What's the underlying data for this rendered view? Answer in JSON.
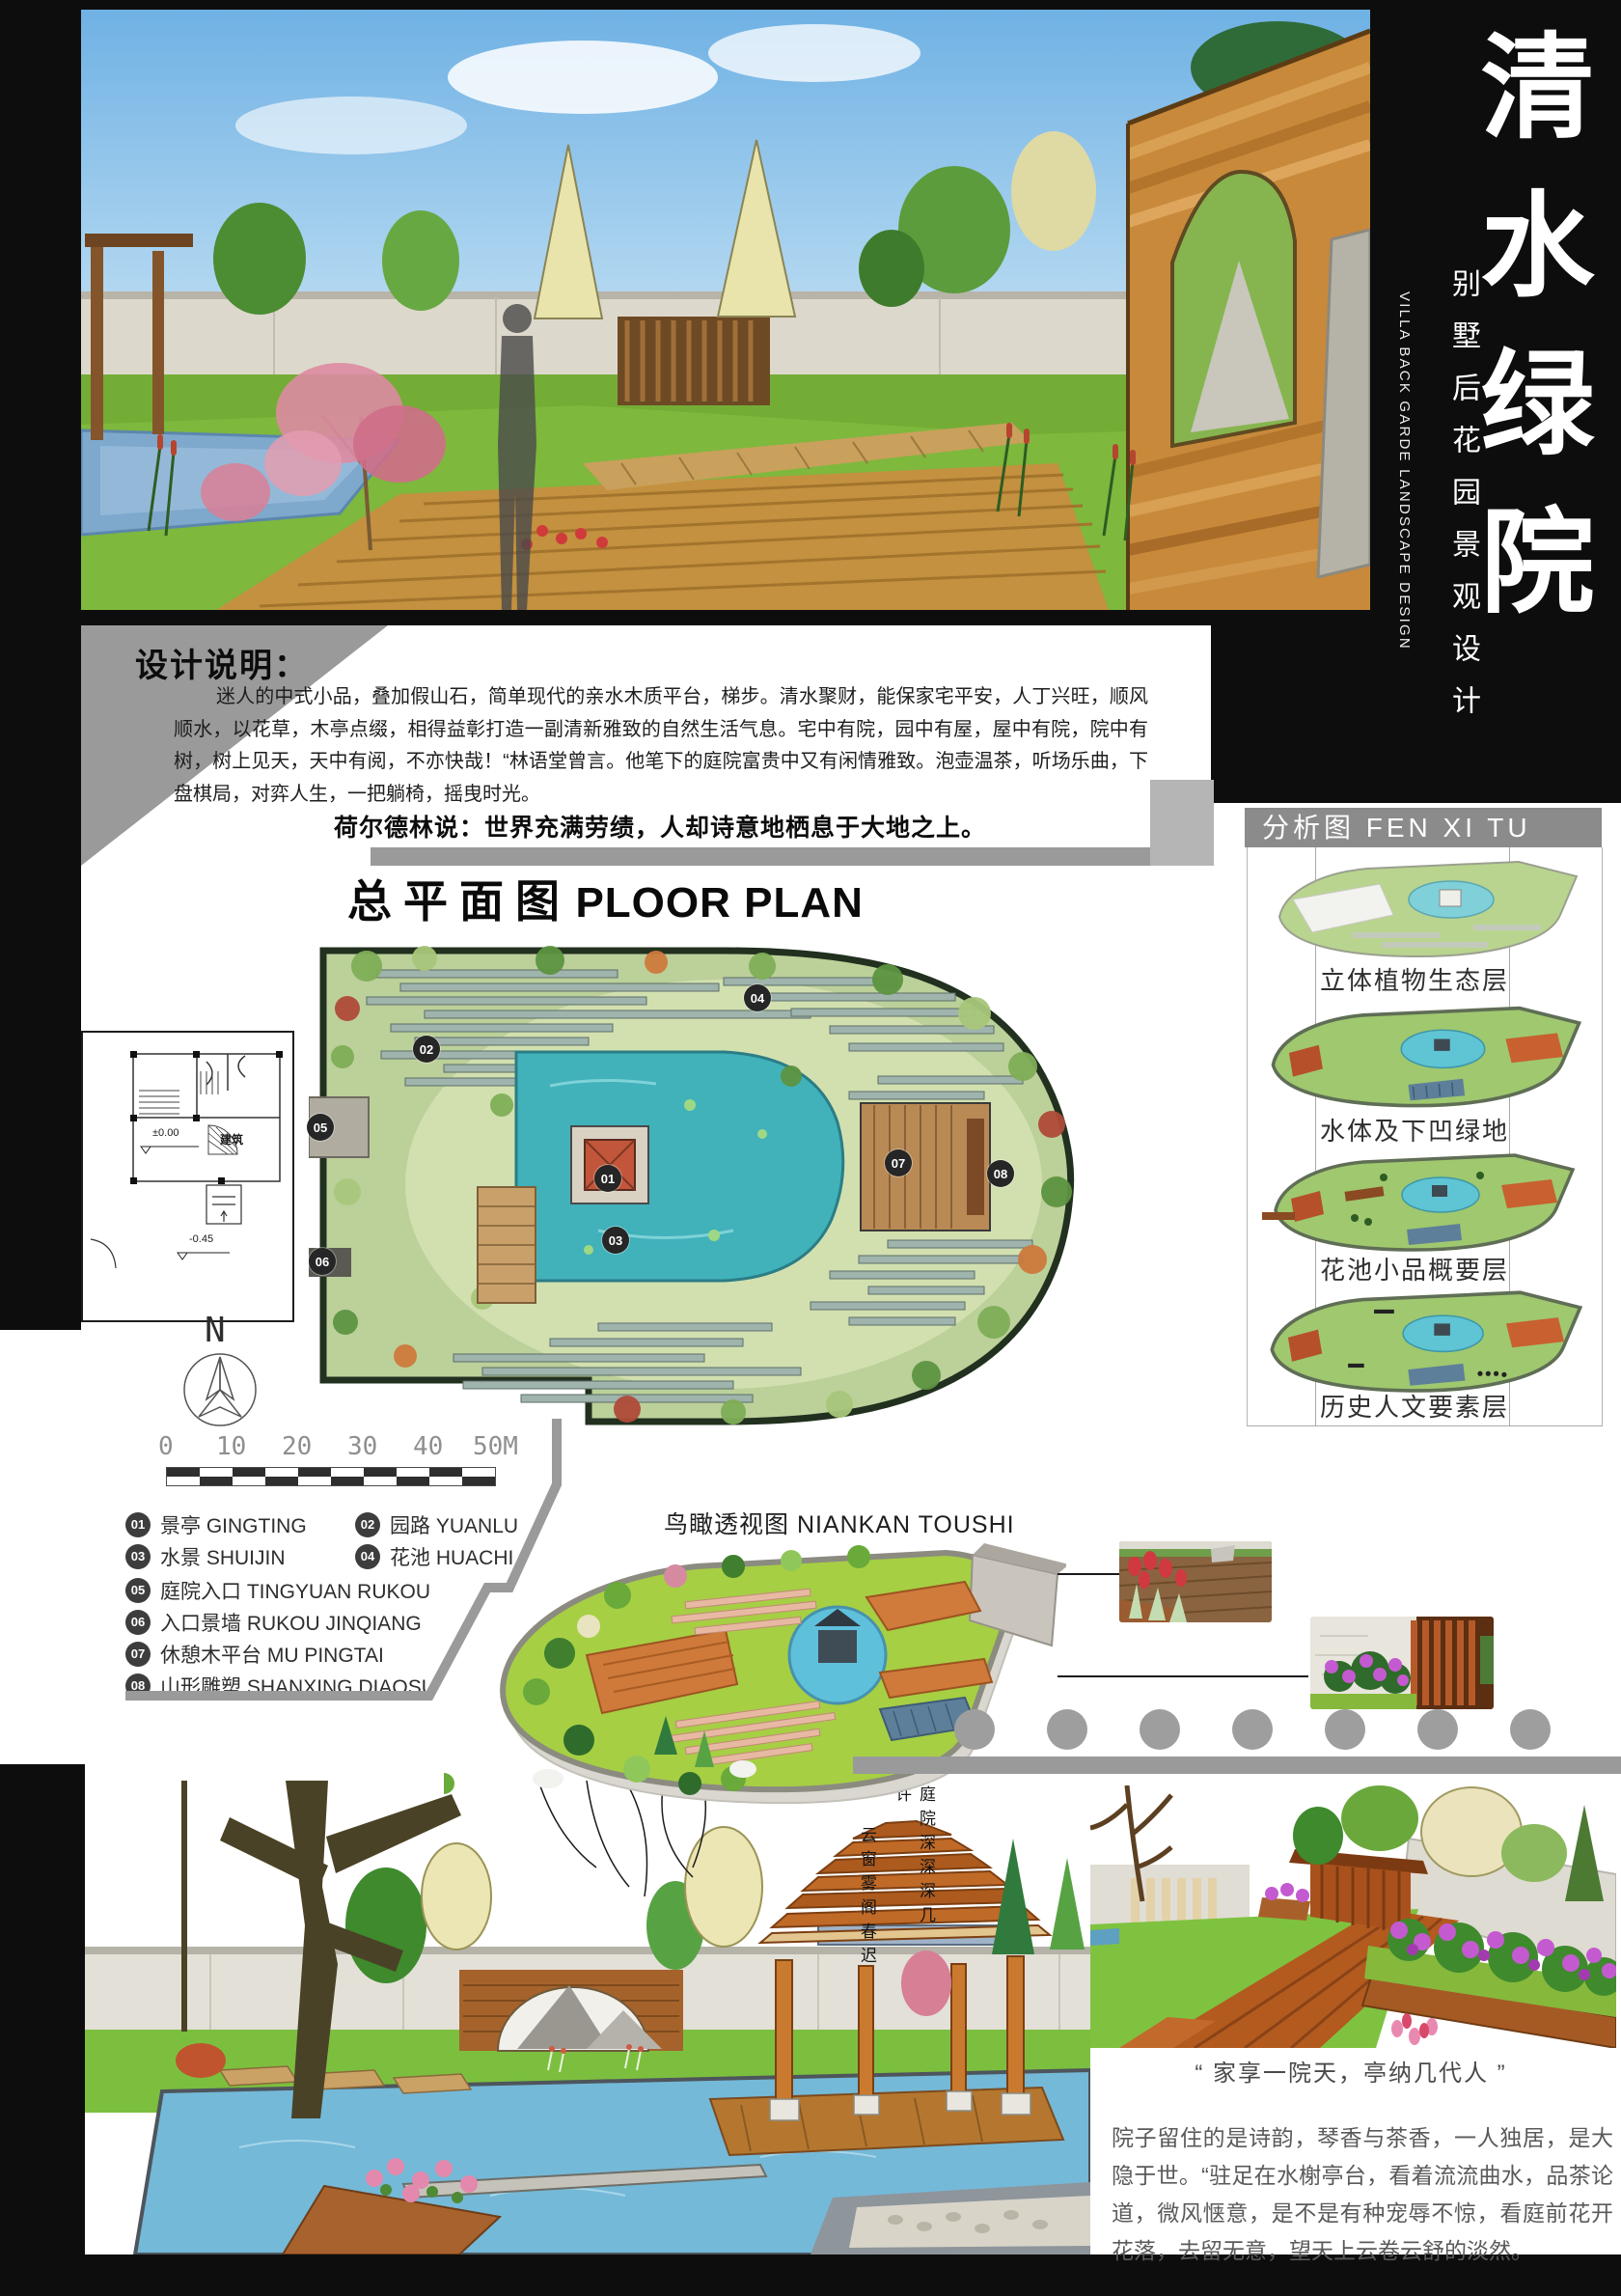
{
  "header": {
    "title": "清水绿院",
    "subtitle": "别墅后花园景观设计",
    "subtitle_en": "VILLA BACK GARDE LANDSCAPE DESIGN"
  },
  "design_notes": {
    "heading": "设计说明：",
    "body": "迷人的中式小品，叠加假山石，简单现代的亲水木质平台，梯步。清水聚财，能保家宅平安，人丁兴旺，顺风顺水，以花草，木亭点缀，相得益彰打造一副清新雅致的自然生活气息。宅中有院，园中有屋，屋中有院，院中有树，树上见天，天中有阅，不亦快哉！“林语堂曾言。他笔下的庭院富贵中又有闲情雅致。泡壶温茶，听场乐曲，下盘棋局，对弈人生，一把躺椅，摇曳时光。",
    "quote": "荷尔德林说：世界充满劳绩，人却诗意地栖息于大地之上。"
  },
  "plan": {
    "title_zh": "总平面图",
    "title_en": "PLOOR PLAN",
    "north": "N",
    "scale_ticks": [
      "0",
      "10",
      "20",
      "30",
      "40",
      "50M"
    ],
    "markers": [
      "01",
      "02",
      "03",
      "04",
      "05",
      "06",
      "07",
      "08"
    ]
  },
  "cad": {
    "label_building": "建筑",
    "level_top": "±0.00",
    "level_bottom": "-0.45"
  },
  "legend": {
    "items": [
      {
        "num": "01",
        "zh": "景亭",
        "en": "GINGTING"
      },
      {
        "num": "02",
        "zh": "园路",
        "en": "YUANLU"
      },
      {
        "num": "03",
        "zh": "水景",
        "en": "SHUIJIN"
      },
      {
        "num": "04",
        "zh": "花池",
        "en": "HUACHI"
      },
      {
        "num": "05",
        "zh": "庭院入口",
        "en": "TINGYUAN RUKOU"
      },
      {
        "num": "06",
        "zh": "入口景墙",
        "en": "RUKOU JINQIANG"
      },
      {
        "num": "07",
        "zh": "休憩木平台",
        "en": "MU PINGTAI"
      },
      {
        "num": "08",
        "zh": "山形雕塑",
        "en": "SHANXING DIAOSU"
      }
    ]
  },
  "analysis": {
    "header": "分析图 FEN XI TU",
    "layers": [
      "立体植物生态层",
      "水体及下凹绿地",
      "花池小品概要层",
      "历史人文要素层"
    ]
  },
  "birdseye": {
    "caption": "鸟瞰透视图 NIANKAN TOUSHI"
  },
  "poem": {
    "col1": "庭院深深深几许",
    "col2": "云窗雾阁春迟"
  },
  "closing": {
    "quote": "“ 家享一院天，亭纳几代人 ”",
    "body": "院子留住的是诗韵，琴香与茶香，一人独居，是大隐于世。“驻足在水榭亭台，看着流流曲水，品茶论道，微风惬意，是不是有种宠辱不惊，看庭前花开花落，去留无意，望天上云卷云舒的淡然。"
  },
  "colors": {
    "panel_black": "#0d0d0d",
    "band_gray": "#9a9a9a",
    "header_gray": "#8b8b8b",
    "lawn_green": "#bcd09a",
    "pool_teal": "#41b1ba",
    "wood_orange": "#c8893b"
  }
}
